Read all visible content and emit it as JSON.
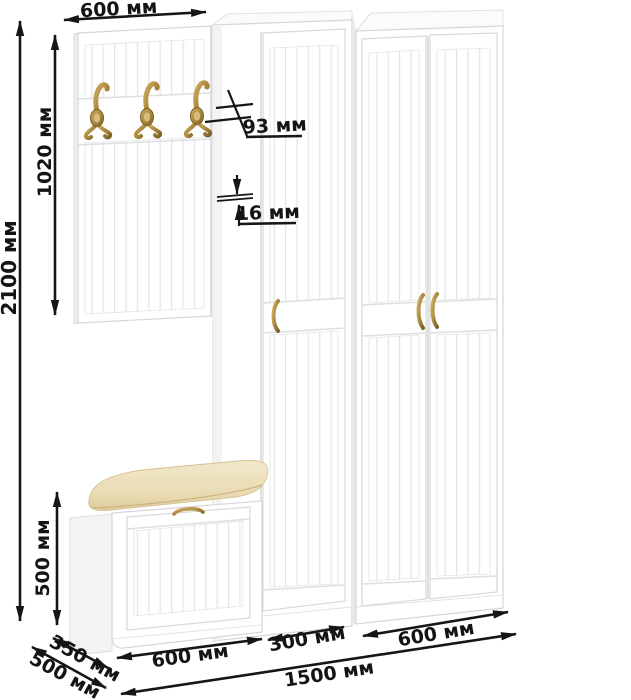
{
  "diagram": {
    "kind": "furniture-dimension-diagram",
    "units": "мм",
    "dimensions": {
      "panel_width": "600 мм",
      "panel_height": "1020 мм",
      "total_height": "2100 мм",
      "hook_depth": "93 мм",
      "panel_thickness": "16 мм",
      "bench_height": "500 мм",
      "bench_depth": "350 мм",
      "total_depth": "500 мм",
      "bench_width": "600 мм",
      "cabinet_width": "300 мм",
      "wardrobe_width": "600 мм",
      "total_width": "1500 мм"
    },
    "colors": {
      "dimension_lines": "#161616",
      "furniture_white": "#ffffff",
      "furniture_outline": "#d6d6d6",
      "groove": "#e3e3e3",
      "cushion": "#ecdfb4",
      "cushion_shadow": "#cdb482",
      "brass": "#b3924a",
      "brass_dark": "#6e5724"
    }
  }
}
